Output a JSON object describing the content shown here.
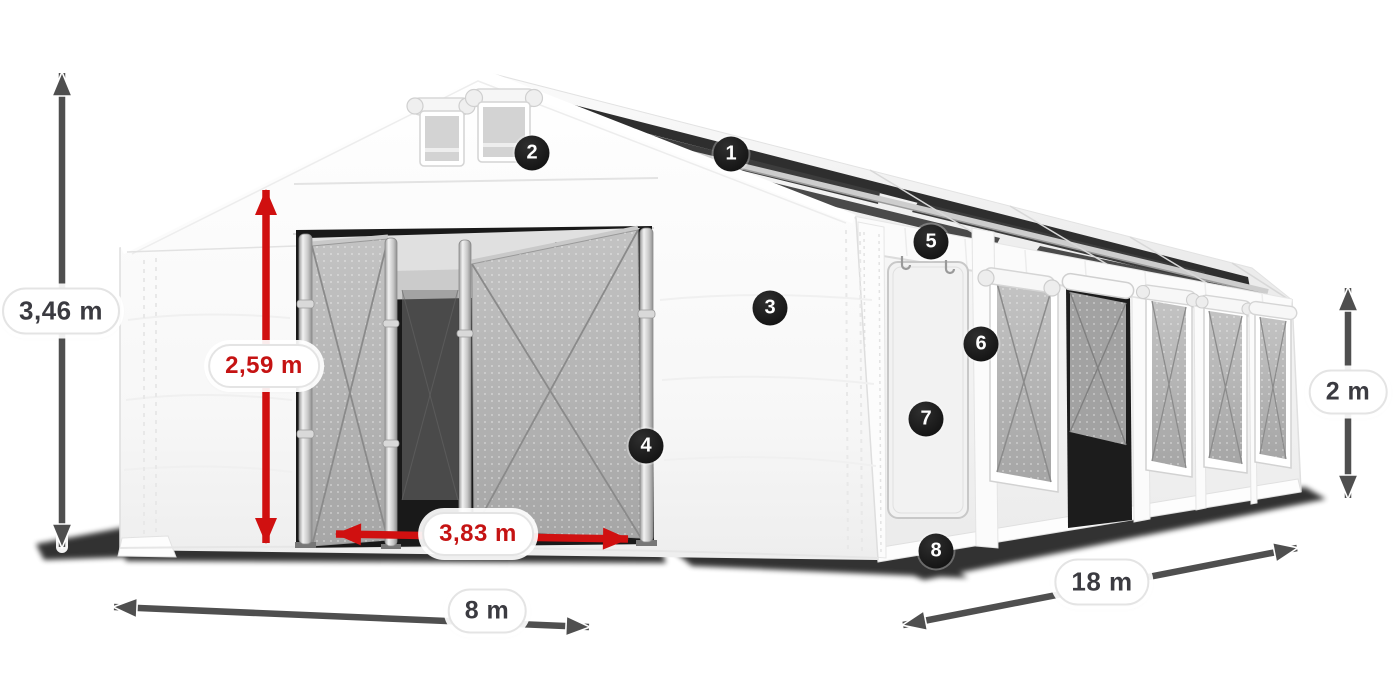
{
  "diagram": {
    "dimensions": [
      {
        "name": "total-height",
        "label": "3,46 m",
        "style": "dark"
      },
      {
        "name": "entrance-height",
        "label": "2,59 m",
        "style": "red"
      },
      {
        "name": "entrance-width",
        "label": "3,83 m",
        "style": "red"
      },
      {
        "name": "tent-width",
        "label": "8 m",
        "style": "dark"
      },
      {
        "name": "tent-length",
        "label": "18 m",
        "style": "dark"
      },
      {
        "name": "side-height",
        "label": "2 m",
        "style": "dark"
      }
    ],
    "markers": [
      {
        "number": "1"
      },
      {
        "number": "2"
      },
      {
        "number": "3"
      },
      {
        "number": "4"
      },
      {
        "number": "5"
      },
      {
        "number": "6"
      },
      {
        "number": "7"
      },
      {
        "number": "8"
      }
    ],
    "colors": {
      "background": "#ffffff",
      "arrow_dark": "#4f4f4f",
      "arrow_red": "#d01010",
      "badge_bg": "#1f1f1f",
      "label_text_dark": "#3b3b41",
      "label_text_red": "#c51313"
    }
  }
}
